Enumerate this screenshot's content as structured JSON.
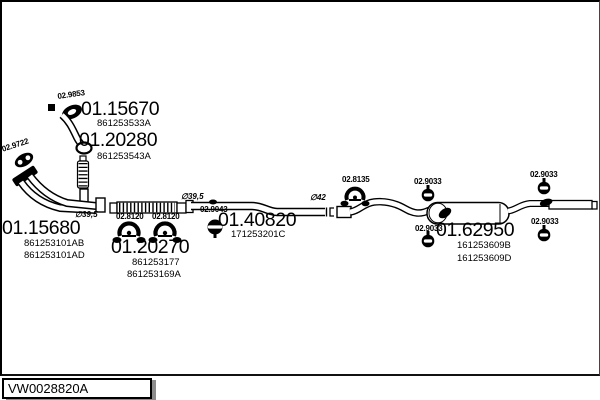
{
  "parts": {
    "p1": {
      "num": "01.15670",
      "ref1": "861253533A"
    },
    "p2": {
      "num": "01.20280",
      "ref1": "861253543A"
    },
    "p3": {
      "num": "01.15680",
      "ref1": "861253101AB",
      "ref2": "861253101AD"
    },
    "p4": {
      "num": "01.20270",
      "ref1": "861253177",
      "ref2": "861253169A"
    },
    "p5": {
      "num": "01.40820",
      "ref1": "171253201C"
    },
    "p6": {
      "num": "01.62950",
      "ref1": "161253609B",
      "ref2": "161253609D"
    }
  },
  "fittings": {
    "gasket": "02.9853",
    "flange": "02.9722",
    "clamp_front_1": "02.8120",
    "clamp_front_2": "02.8120",
    "mount": "02.9043",
    "clamp_mid": "02.8135",
    "hanger_1": "02.9033",
    "hanger_2": "02.9033",
    "hanger_3": "02.9033",
    "hanger_4": "02.9033"
  },
  "dimensions": {
    "pipe_front": "∅39,5",
    "pipe_mid": "∅39,5",
    "pipe_rear": "∅42"
  },
  "footer": {
    "code": "VW0028820A"
  },
  "colors": {
    "line": "#000000",
    "background": "#ffffff",
    "shadow": "#8c8c8c"
  }
}
